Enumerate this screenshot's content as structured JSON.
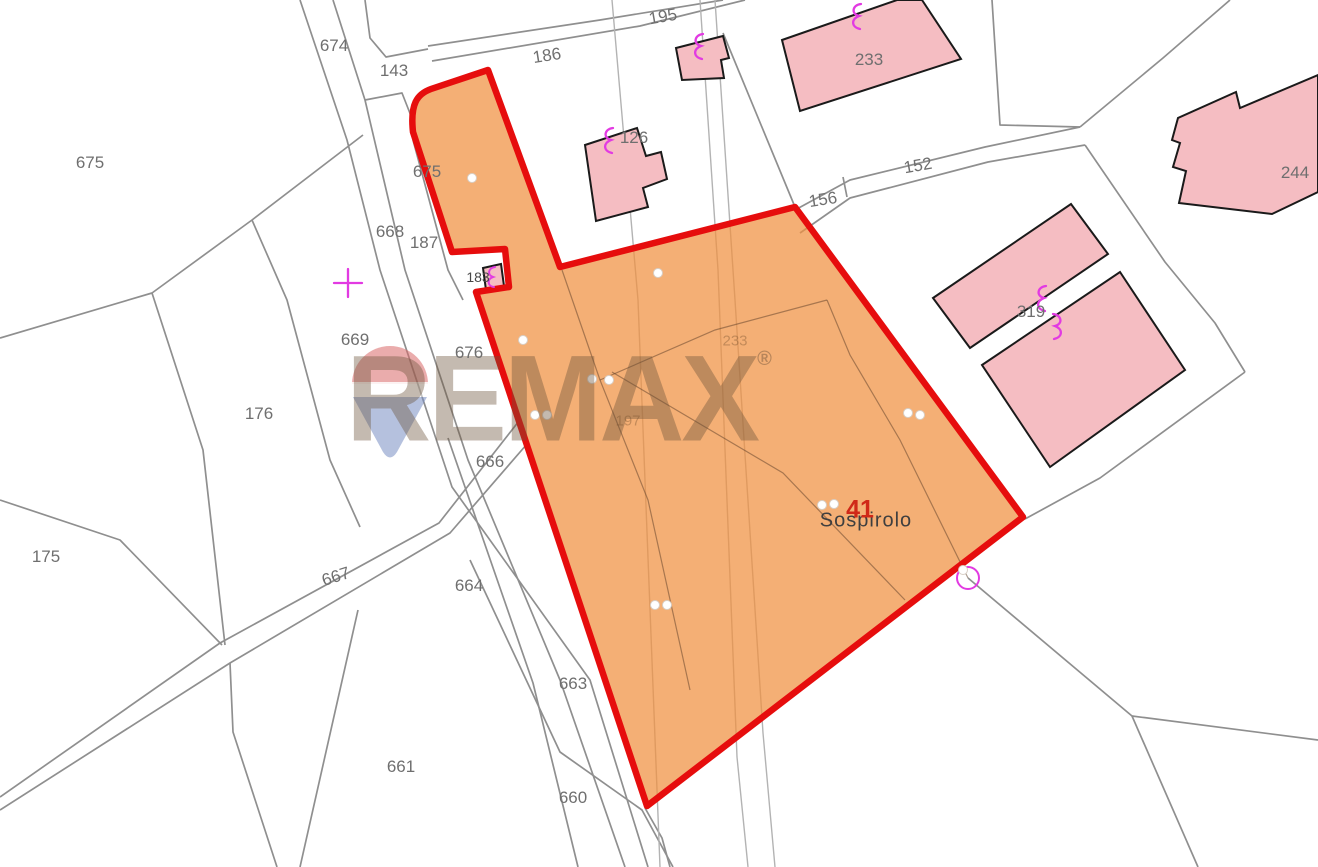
{
  "map": {
    "type": "cadastral-map",
    "watermark": {
      "brand": "REMAX",
      "registered_mark": "®"
    },
    "place_label": "Sospirolo",
    "highlighted_parcel": {
      "number": "41",
      "outline_color": "#e60d0d",
      "fill_color": "#f09040"
    },
    "colors": {
      "building_fill": "#f5bdc2",
      "building_outline": "#1a1a1a",
      "boundary_line_gray": "#8f8f8f",
      "symbol_magenta": "#e23ae2",
      "label_gray": "#6f6f6f",
      "highlight_red": "#e60d0d"
    },
    "symbols": [
      "survey-cross",
      "survey-circle",
      "building-annotation-curl",
      "survey-point-dot"
    ],
    "labels": [
      {
        "id": "674",
        "text": "674",
        "x": 334,
        "y": 46,
        "rot": 0,
        "cls": "parcel"
      },
      {
        "id": "143",
        "text": "143",
        "x": 394,
        "y": 71,
        "rot": 0,
        "cls": "parcel"
      },
      {
        "id": "186",
        "text": "186",
        "x": 547,
        "y": 56,
        "rot": -9,
        "cls": "parcel"
      },
      {
        "id": "195",
        "text": "195",
        "x": 663,
        "y": 17,
        "rot": -10,
        "cls": "parcel"
      },
      {
        "id": "675",
        "text": "675",
        "x": 90,
        "y": 163,
        "rot": 0,
        "cls": "parcel"
      },
      {
        "id": "675b",
        "text": "675",
        "x": 427,
        "y": 172,
        "rot": 0,
        "cls": "parcel"
      },
      {
        "id": "126",
        "text": "126",
        "x": 634,
        "y": 138,
        "rot": 0,
        "cls": "parcel"
      },
      {
        "id": "233",
        "text": "233",
        "x": 869,
        "y": 60,
        "rot": 0,
        "cls": "parcel"
      },
      {
        "id": "152",
        "text": "152",
        "x": 918,
        "y": 166,
        "rot": -10,
        "cls": "parcel"
      },
      {
        "id": "156",
        "text": "156",
        "x": 823,
        "y": 200,
        "rot": -9,
        "cls": "parcel"
      },
      {
        "id": "244",
        "text": "244",
        "x": 1295,
        "y": 173,
        "rot": 0,
        "cls": "parcel"
      },
      {
        "id": "319",
        "text": "319",
        "x": 1031,
        "y": 312,
        "rot": 0,
        "cls": "parcel"
      },
      {
        "id": "668",
        "text": "668",
        "x": 390,
        "y": 232,
        "rot": 0,
        "cls": "parcel"
      },
      {
        "id": "187",
        "text": "187",
        "x": 424,
        "y": 243,
        "rot": 0,
        "cls": "parcel"
      },
      {
        "id": "183",
        "text": "183",
        "x": 478,
        "y": 277,
        "rot": 0,
        "cls": "small"
      },
      {
        "id": "669",
        "text": "669",
        "x": 355,
        "y": 340,
        "rot": 0,
        "cls": "parcel"
      },
      {
        "id": "676",
        "text": "676",
        "x": 469,
        "y": 353,
        "rot": 0,
        "cls": "parcel"
      },
      {
        "id": "176",
        "text": "176",
        "x": 259,
        "y": 414,
        "rot": 0,
        "cls": "parcel"
      },
      {
        "id": "175",
        "text": "175",
        "x": 46,
        "y": 557,
        "rot": 0,
        "cls": "parcel"
      },
      {
        "id": "666",
        "text": "666",
        "x": 490,
        "y": 462,
        "rot": 0,
        "cls": "parcel"
      },
      {
        "id": "667",
        "text": "667",
        "x": 336,
        "y": 577,
        "rot": -18,
        "cls": "parcel"
      },
      {
        "id": "664",
        "text": "664",
        "x": 469,
        "y": 586,
        "rot": 0,
        "cls": "parcel"
      },
      {
        "id": "663",
        "text": "663",
        "x": 573,
        "y": 684,
        "rot": 0,
        "cls": "parcel"
      },
      {
        "id": "661",
        "text": "661",
        "x": 401,
        "y": 767,
        "rot": 0,
        "cls": "parcel"
      },
      {
        "id": "660",
        "text": "660",
        "x": 573,
        "y": 798,
        "rot": 0,
        "cls": "parcel"
      },
      {
        "id": "f233",
        "text": "233",
        "x": 735,
        "y": 341,
        "rot": 0,
        "cls": "faint"
      },
      {
        "id": "f197",
        "text": "197",
        "x": 628,
        "y": 421,
        "rot": 0,
        "cls": "faint"
      },
      {
        "id": "sospirolo",
        "text": "Sospirolo",
        "x": 866,
        "y": 521,
        "rot": 0,
        "cls": "place"
      },
      {
        "id": "41",
        "text": "41",
        "x": 860,
        "y": 510,
        "rot": 0,
        "cls": "highlight"
      }
    ]
  }
}
